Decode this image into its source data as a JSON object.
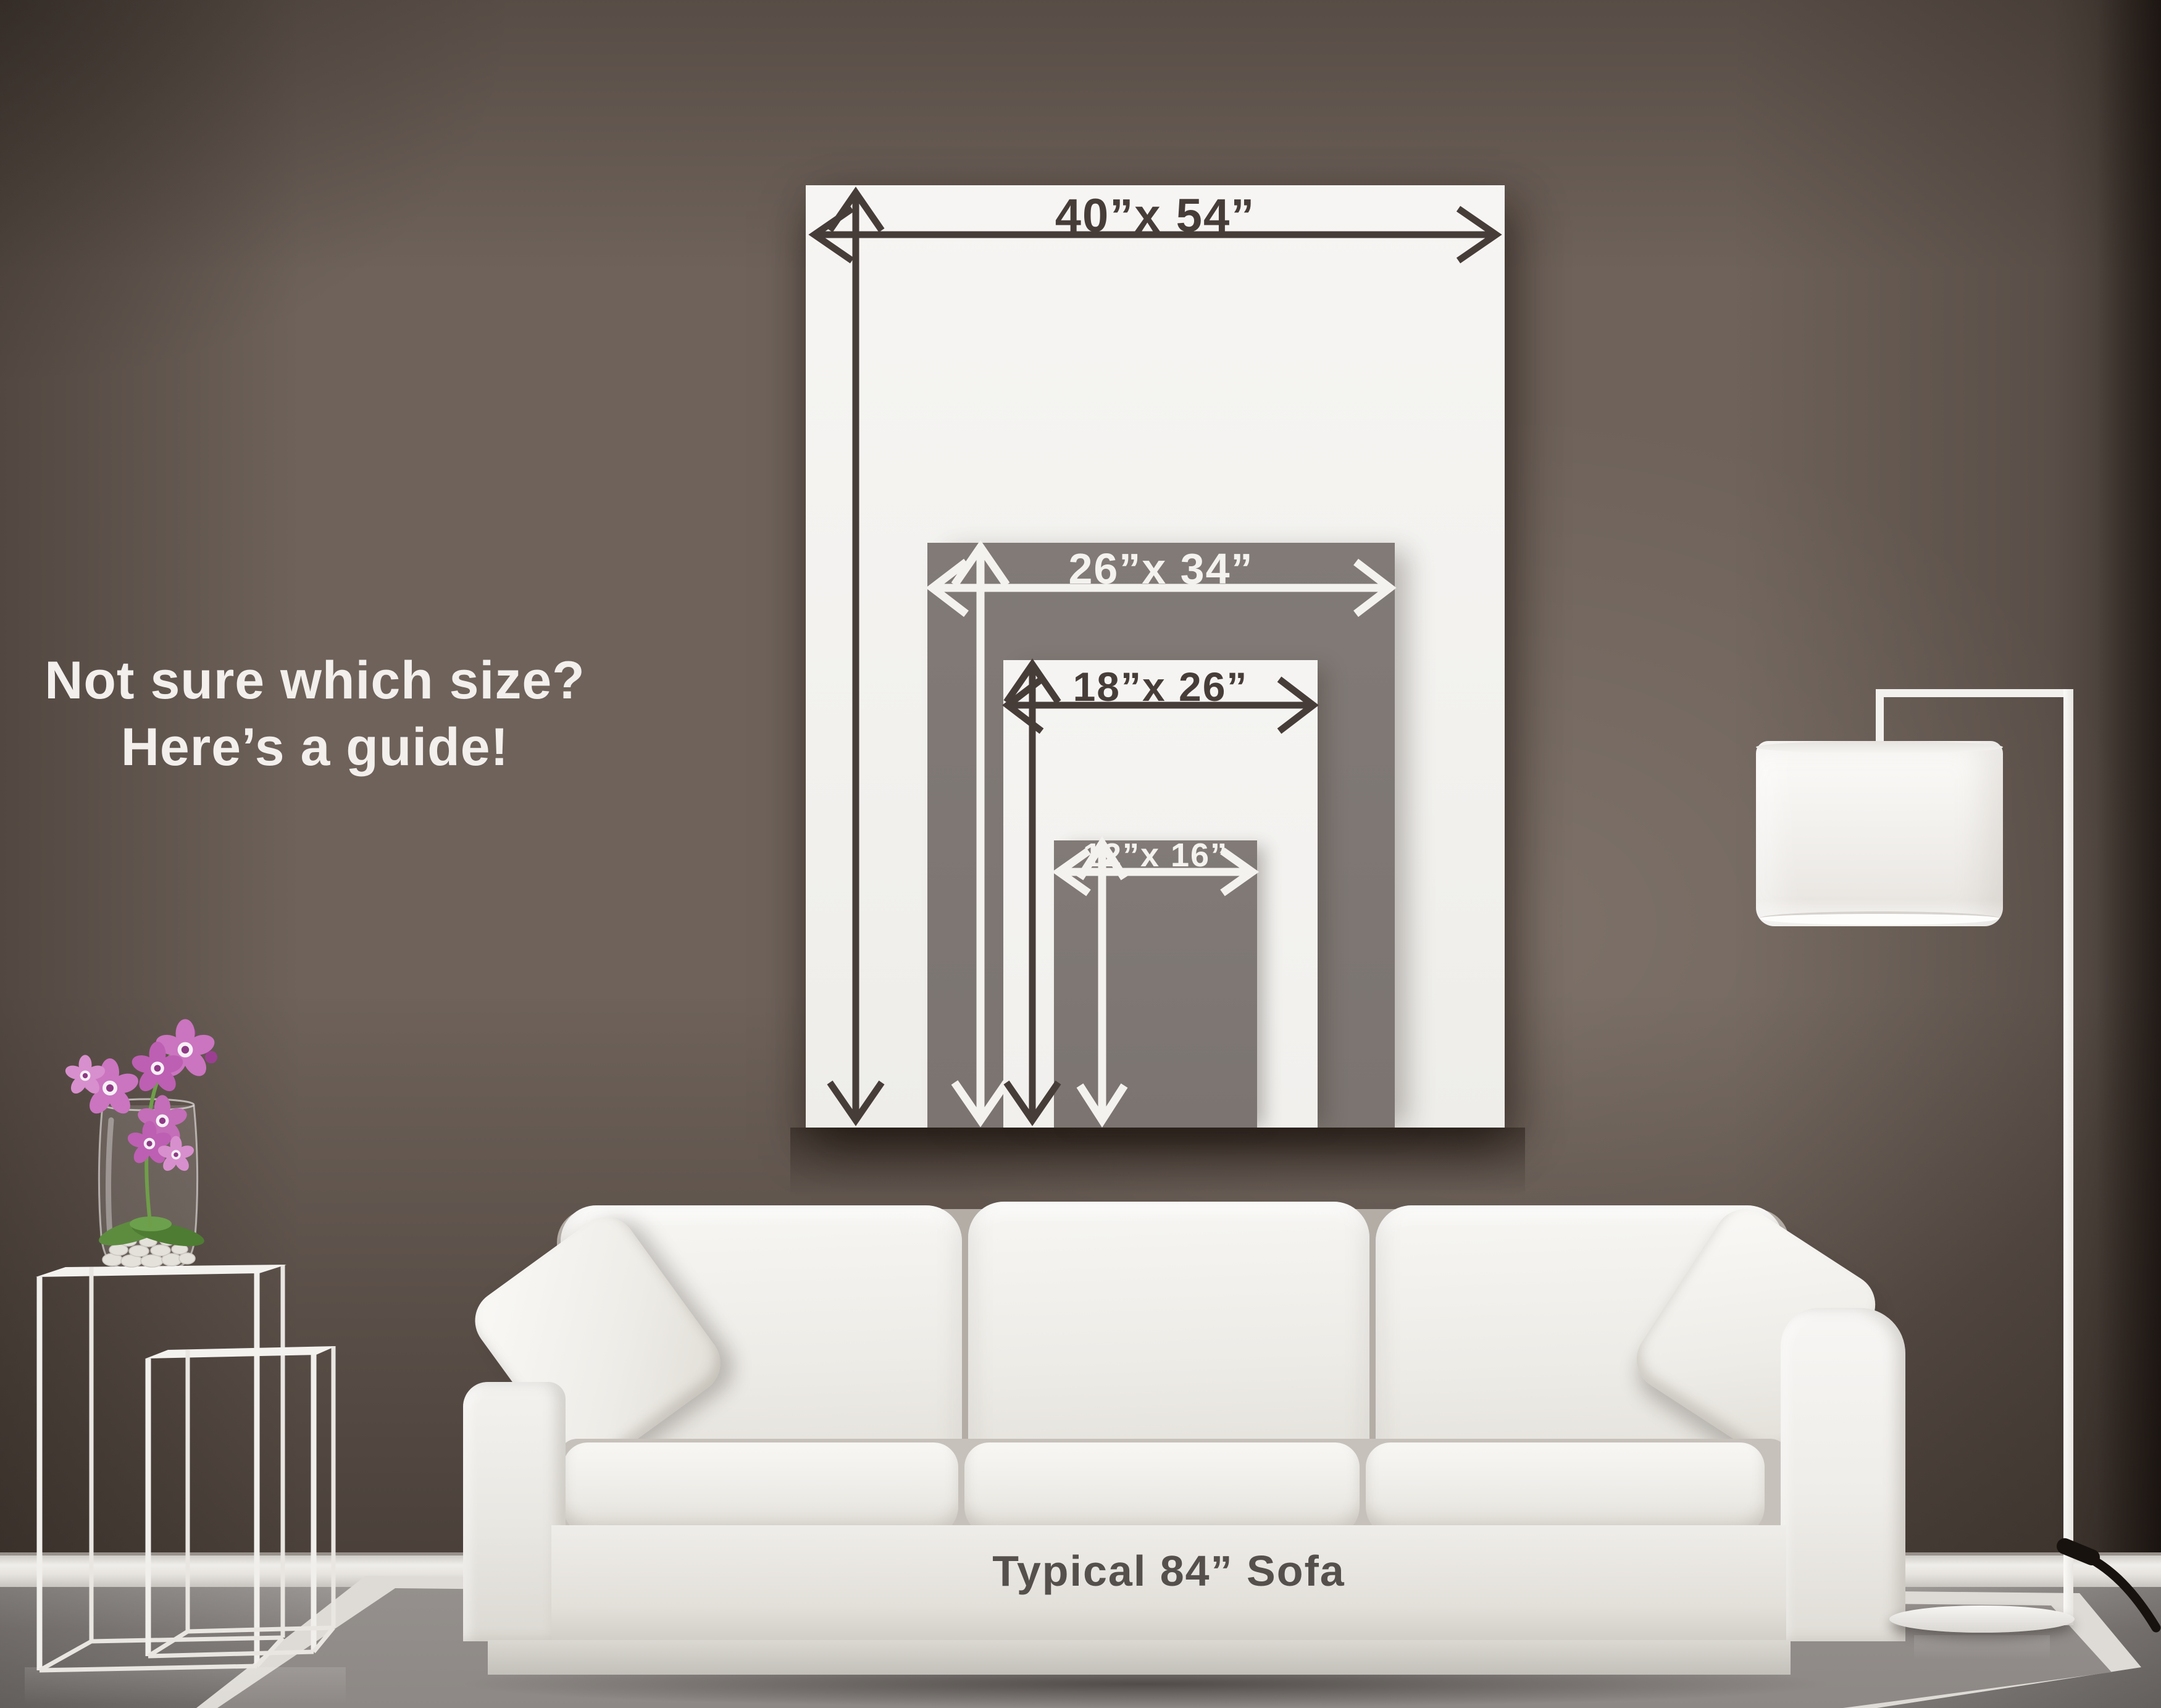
{
  "headline": {
    "line1": "Not sure which size?",
    "line2": "Here’s a guide!"
  },
  "size_guide": {
    "sizes": [
      {
        "id": "40x54",
        "label": "40”x 54”",
        "panel": "white",
        "text": "dark"
      },
      {
        "id": "26x34",
        "label": "26”x 34”",
        "panel": "gray",
        "text": "light"
      },
      {
        "id": "18x26",
        "label": "18”x 26”",
        "panel": "white",
        "text": "dark"
      },
      {
        "id": "12x16",
        "label": "12”x 16”",
        "panel": "gray",
        "text": "light"
      }
    ]
  },
  "sofa": {
    "label": "Typical 84” Sofa"
  },
  "colors": {
    "wall": "#6e625a",
    "poster_white": "#f4f3f0",
    "panel_gray": "#7d7672",
    "arrow_dark": "#473d38",
    "arrow_light": "#f4f2ef",
    "label_dark": "#473d38",
    "label_light": "#f4f2ef",
    "headline": "#f2efec",
    "sofa_label": "#55504b",
    "flower_pink": "#c46db8",
    "leaf_green": "#5d8c3f"
  }
}
